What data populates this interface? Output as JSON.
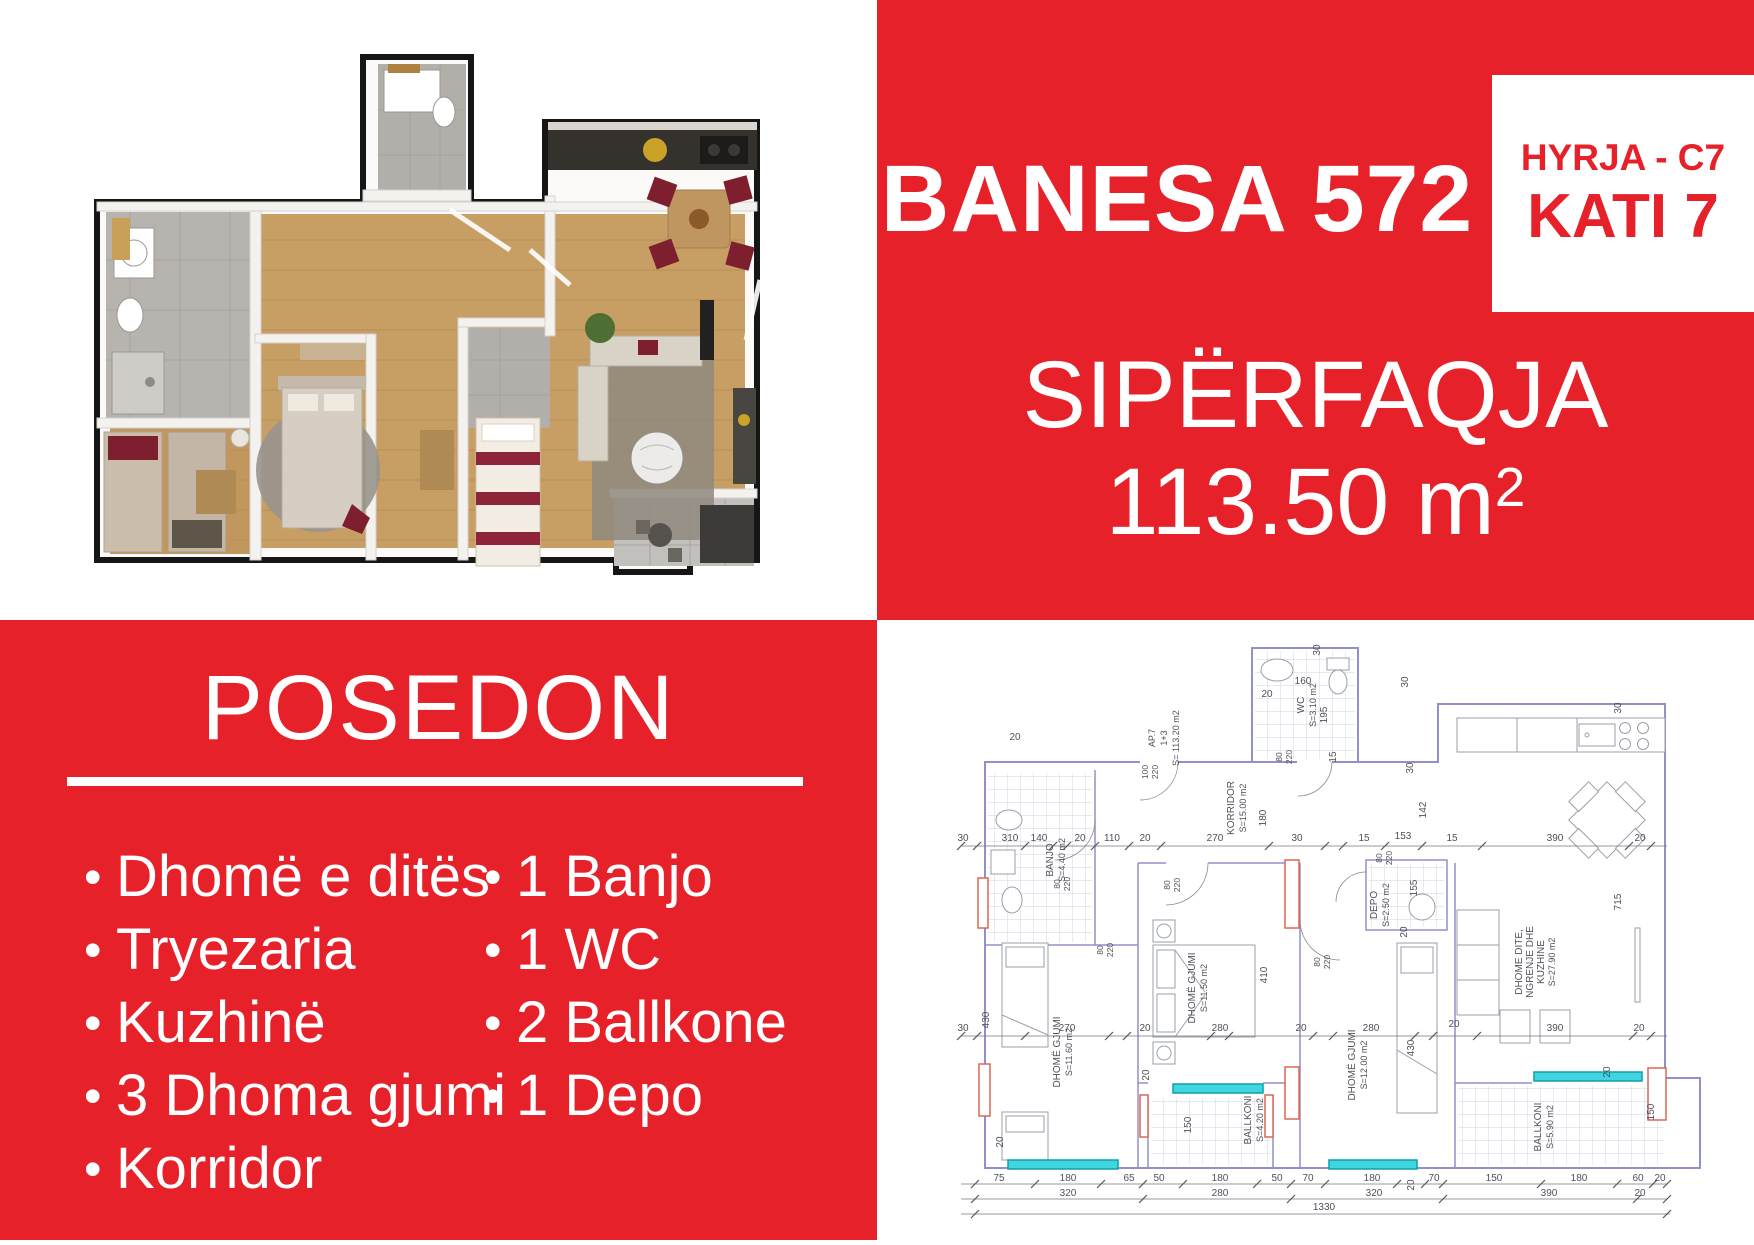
{
  "colors": {
    "brand_red": "#e6212a",
    "plan_wall": "#9090ca",
    "plan_accent_red": "#dd6752",
    "plan_window_cyan": "#3fd6e0",
    "plan_text": "#50505a",
    "render_wood": "#c79e63",
    "render_maroon": "#7e1f30"
  },
  "top_right": {
    "title": "BANESA 572",
    "entry_label": "HYRJA - C7",
    "floor_label": "KATI 7",
    "area_title": "SIPËRFAQJA",
    "area_value": "113.50 m",
    "area_sup": "2"
  },
  "possession": {
    "title": "POSEDON",
    "bullet": "•",
    "left_items": [
      "Dhomë e ditës",
      "Tryezaria",
      "Kuzhinë",
      "3 Dhoma gjumi",
      "Korridor"
    ],
    "right_items": [
      "1 Banjo",
      "1 WC",
      "2 Ballkone",
      "1 Depo"
    ]
  },
  "plan": {
    "texts": [
      {
        "t": "WC",
        "x": 427,
        "y": 85,
        "r": -90,
        "s": 10
      },
      {
        "t": "S=3.10 m2",
        "x": 439,
        "y": 85,
        "r": -90,
        "s": 9
      },
      {
        "t": "KORRIDOR",
        "x": 357,
        "y": 188,
        "r": -90,
        "s": 10
      },
      {
        "t": "S=15.00 m2",
        "x": 369,
        "y": 188,
        "r": -90,
        "s": 9
      },
      {
        "t": "AP.7",
        "x": 278,
        "y": 118,
        "r": -90,
        "s": 9
      },
      {
        "t": "1+3",
        "x": 290,
        "y": 118,
        "r": -90,
        "s": 9
      },
      {
        "t": "S= 113.20 m2",
        "x": 302,
        "y": 118,
        "r": -90,
        "s": 9
      },
      {
        "t": "BANJO",
        "x": 176,
        "y": 240,
        "r": -90,
        "s": 10
      },
      {
        "t": "S=4.40 m2",
        "x": 188,
        "y": 240,
        "r": -90,
        "s": 9
      },
      {
        "t": "DEPO",
        "x": 500,
        "y": 285,
        "r": -90,
        "s": 10
      },
      {
        "t": "S=2.50 m2",
        "x": 512,
        "y": 285,
        "r": -90,
        "s": 9
      },
      {
        "t": "DHOMË GJUMI",
        "x": 183,
        "y": 432,
        "r": -90,
        "s": 10
      },
      {
        "t": "S=11.60 m2",
        "x": 195,
        "y": 432,
        "r": -90,
        "s": 9
      },
      {
        "t": "DHOMË GJUMI",
        "x": 318,
        "y": 368,
        "r": -90,
        "s": 10
      },
      {
        "t": "S=11.50 m2",
        "x": 330,
        "y": 368,
        "r": -90,
        "s": 9
      },
      {
        "t": "DHOMË GJUMI",
        "x": 478,
        "y": 445,
        "r": -90,
        "s": 10
      },
      {
        "t": "S=12.00 m2",
        "x": 490,
        "y": 445,
        "r": -90,
        "s": 9
      },
      {
        "t": "DHOME DITE,",
        "x": 645,
        "y": 342,
        "r": -90,
        "s": 10
      },
      {
        "t": "NGRENJE DHE",
        "x": 656,
        "y": 342,
        "r": -90,
        "s": 10
      },
      {
        "t": "KUZHINE",
        "x": 667,
        "y": 342,
        "r": -90,
        "s": 10
      },
      {
        "t": "S=27.90 m2",
        "x": 678,
        "y": 342,
        "r": -90,
        "s": 9
      },
      {
        "t": "BALLKONI",
        "x": 374,
        "y": 500,
        "r": -90,
        "s": 10
      },
      {
        "t": "S=4.20 m2",
        "x": 386,
        "y": 500,
        "r": -90,
        "s": 9
      },
      {
        "t": "BALLKONI",
        "x": 664,
        "y": 507,
        "r": -90,
        "s": 10
      },
      {
        "t": "S=5.90 m2",
        "x": 676,
        "y": 507,
        "r": -90,
        "s": 9
      },
      {
        "t": "100",
        "x": 271,
        "y": 152,
        "r": -90,
        "s": 8.5
      },
      {
        "t": "220",
        "x": 281,
        "y": 152,
        "r": -90,
        "s": 8.5
      },
      {
        "t": "80",
        "x": 405,
        "y": 137,
        "r": -90,
        "s": 8.5
      },
      {
        "t": "220",
        "x": 415,
        "y": 137,
        "r": -90,
        "s": 8.5
      },
      {
        "t": "80",
        "x": 183,
        "y": 264,
        "r": -90,
        "s": 8.5
      },
      {
        "t": "220",
        "x": 193,
        "y": 264,
        "r": -90,
        "s": 8.5
      },
      {
        "t": "80",
        "x": 226,
        "y": 330,
        "r": -90,
        "s": 8.5
      },
      {
        "t": "220",
        "x": 236,
        "y": 330,
        "r": -90,
        "s": 8.5
      },
      {
        "t": "80",
        "x": 293,
        "y": 265,
        "r": -90,
        "s": 8.5
      },
      {
        "t": "220",
        "x": 303,
        "y": 265,
        "r": -90,
        "s": 8.5
      },
      {
        "t": "80",
        "x": 443,
        "y": 342,
        "r": -90,
        "s": 8.5
      },
      {
        "t": "220",
        "x": 453,
        "y": 342,
        "r": -90,
        "s": 8.5
      },
      {
        "t": "80",
        "x": 505,
        "y": 238,
        "r": -90,
        "s": 8.5
      },
      {
        "t": "220",
        "x": 515,
        "y": 238,
        "r": -90,
        "s": 8.5
      },
      {
        "t": "30",
        "x": 443,
        "y": 30,
        "r": -90
      },
      {
        "t": "20",
        "x": 390,
        "y": 77
      },
      {
        "t": "160",
        "x": 426,
        "y": 64
      },
      {
        "t": "195",
        "x": 450,
        "y": 95,
        "r": -90
      },
      {
        "t": "15",
        "x": 459,
        "y": 137,
        "r": -90
      },
      {
        "t": "30",
        "x": 531,
        "y": 62,
        "r": -90
      },
      {
        "t": "30",
        "x": 744,
        "y": 88,
        "r": -90
      },
      {
        "t": "142",
        "x": 549,
        "y": 190,
        "r": -90
      },
      {
        "t": "30",
        "x": 536,
        "y": 148,
        "r": -90
      },
      {
        "t": "20",
        "x": 138,
        "y": 120
      },
      {
        "t": "30",
        "x": 86,
        "y": 221
      },
      {
        "t": "310",
        "x": 133,
        "y": 221
      },
      {
        "t": "140",
        "x": 162,
        "y": 221
      },
      {
        "t": "20",
        "x": 203,
        "y": 221
      },
      {
        "t": "110",
        "x": 235,
        "y": 221
      },
      {
        "t": "20",
        "x": 268,
        "y": 221
      },
      {
        "t": "270",
        "x": 338,
        "y": 221
      },
      {
        "t": "30",
        "x": 420,
        "y": 221
      },
      {
        "t": "15",
        "x": 487,
        "y": 221
      },
      {
        "t": "153",
        "x": 526,
        "y": 219
      },
      {
        "t": "15",
        "x": 575,
        "y": 221
      },
      {
        "t": "390",
        "x": 678,
        "y": 221
      },
      {
        "t": "20",
        "x": 763,
        "y": 221
      },
      {
        "t": "180",
        "x": 389,
        "y": 198,
        "r": -90
      },
      {
        "t": "155",
        "x": 540,
        "y": 268,
        "r": -90
      },
      {
        "t": "20",
        "x": 530,
        "y": 312,
        "r": -90
      },
      {
        "t": "30",
        "x": 86,
        "y": 411
      },
      {
        "t": "430",
        "x": 112,
        "y": 400,
        "r": -90
      },
      {
        "t": "270",
        "x": 190,
        "y": 411
      },
      {
        "t": "20",
        "x": 268,
        "y": 411
      },
      {
        "t": "280",
        "x": 343,
        "y": 411
      },
      {
        "t": "20",
        "x": 424,
        "y": 411
      },
      {
        "t": "280",
        "x": 494,
        "y": 411
      },
      {
        "t": "430",
        "x": 537,
        "y": 428,
        "r": -90
      },
      {
        "t": "20",
        "x": 577,
        "y": 407
      },
      {
        "t": "390",
        "x": 678,
        "y": 411
      },
      {
        "t": "20",
        "x": 762,
        "y": 411
      },
      {
        "t": "410",
        "x": 390,
        "y": 355,
        "r": -90
      },
      {
        "t": "715",
        "x": 744,
        "y": 282,
        "r": -90
      },
      {
        "t": "20",
        "x": 272,
        "y": 455,
        "r": -90
      },
      {
        "t": "150",
        "x": 314,
        "y": 505,
        "r": -90
      },
      {
        "t": "20",
        "x": 733,
        "y": 452,
        "r": -90
      },
      {
        "t": "150",
        "x": 777,
        "y": 492,
        "r": -90
      },
      {
        "t": "20",
        "x": 126,
        "y": 522,
        "r": -90
      },
      {
        "t": "75",
        "x": 122,
        "y": 561
      },
      {
        "t": "180",
        "x": 191,
        "y": 561
      },
      {
        "t": "65",
        "x": 252,
        "y": 561
      },
      {
        "t": "50",
        "x": 282,
        "y": 561
      },
      {
        "t": "180",
        "x": 343,
        "y": 561
      },
      {
        "t": "50",
        "x": 400,
        "y": 561
      },
      {
        "t": "70",
        "x": 431,
        "y": 561
      },
      {
        "t": "180",
        "x": 495,
        "y": 561
      },
      {
        "t": "20",
        "x": 537,
        "y": 565,
        "r": -90
      },
      {
        "t": "70",
        "x": 557,
        "y": 561
      },
      {
        "t": "150",
        "x": 617,
        "y": 561
      },
      {
        "t": "180",
        "x": 702,
        "y": 561
      },
      {
        "t": "60",
        "x": 761,
        "y": 561
      },
      {
        "t": "20",
        "x": 783,
        "y": 561
      },
      {
        "t": "320",
        "x": 191,
        "y": 576
      },
      {
        "t": "280",
        "x": 343,
        "y": 576
      },
      {
        "t": "320",
        "x": 497,
        "y": 576
      },
      {
        "t": "390",
        "x": 672,
        "y": 576
      },
      {
        "t": "20",
        "x": 763,
        "y": 576
      },
      {
        "t": "1330",
        "x": 447,
        "y": 590
      }
    ],
    "dimlines": [
      {
        "y": 564,
        "x1": 84,
        "x2": 790,
        "ticks": [
          98,
          158,
          224,
          266,
          306,
          380,
          414,
          448,
          520,
          548,
          566,
          664,
          740,
          776,
          790
        ]
      },
      {
        "y": 579,
        "x1": 84,
        "x2": 790,
        "ticks": [
          98,
          266,
          414,
          566,
          760,
          790
        ]
      },
      {
        "y": 594,
        "x1": 84,
        "x2": 793,
        "ticks": [
          98,
          790
        ]
      },
      {
        "y": 226,
        "x1": 84,
        "x2": 790,
        "ticks": [
          84,
          100,
          148,
          176,
          190,
          218,
          252,
          284,
          392,
          448,
          466,
          508,
          545,
          605,
          752,
          774
        ]
      },
      {
        "y": 416,
        "x1": 84,
        "x2": 790,
        "ticks": [
          84,
          100,
          148,
          232,
          250,
          334,
          352,
          436,
          456,
          538,
          556,
          600,
          756,
          774
        ]
      }
    ]
  }
}
